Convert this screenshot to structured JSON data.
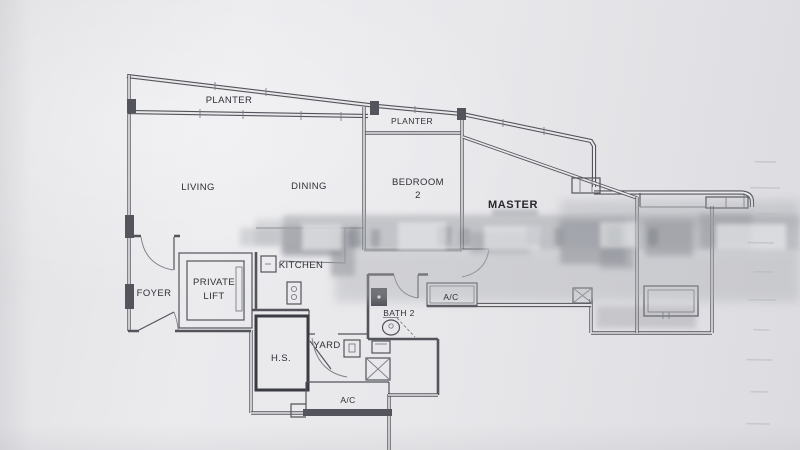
{
  "document": {
    "kind_hint": "floor plan drawing"
  },
  "colors": {
    "paper": "#e9e9ec",
    "ink": "#54555c",
    "ink_dark": "#3b3c42",
    "label_text": "#2e2f35",
    "blur_band": "#9da0a6"
  },
  "labels": {
    "planter_left": "PLANTER",
    "planter_right": "PLANTER",
    "living": "LIVING",
    "dining": "DINING",
    "bedroom2_line1": "BEDROOM",
    "bedroom2_line2": "2",
    "master": "MASTER",
    "kitchen": "KITCHEN",
    "foyer": "FOYER",
    "private_lift_line1": "PRIVATE",
    "private_lift_line2": "LIFT",
    "hs": "H.S.",
    "yard": "YARD",
    "bath2": "BATH 2",
    "ac_upper": "A/C",
    "ac_lower": "A/C"
  }
}
